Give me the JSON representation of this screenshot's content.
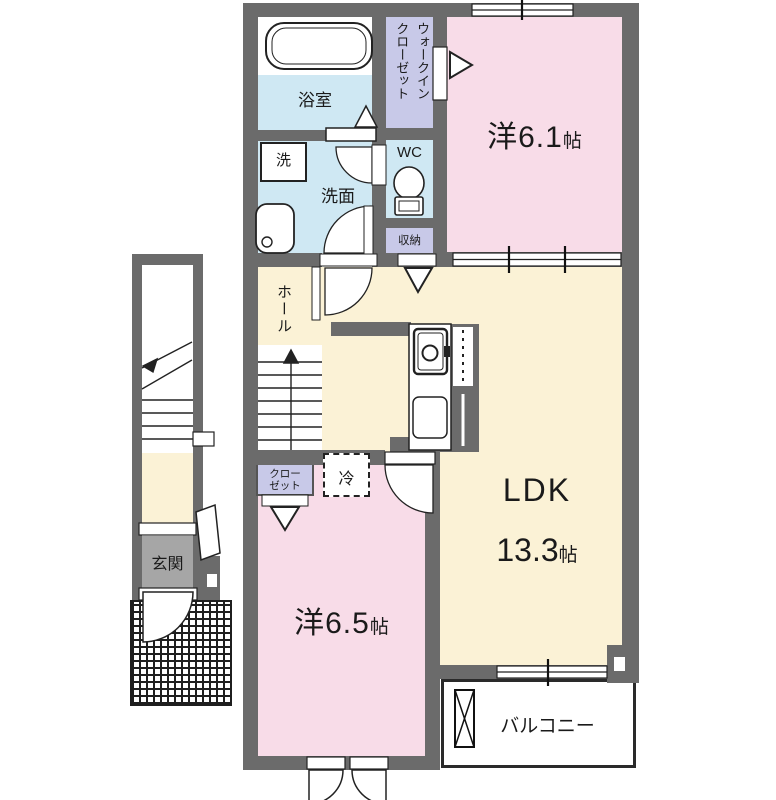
{
  "floorplan": {
    "rooms": {
      "bathroom": {
        "label": "浴室"
      },
      "walk_in_closet": {
        "label_line1": "ウォークイン",
        "label_line2": "クローゼット"
      },
      "bedroom1": {
        "label": "洋6.1",
        "unit": "帖"
      },
      "laundry": {
        "label": "洗"
      },
      "washroom": {
        "label": "洗面"
      },
      "wc": {
        "label": "WC"
      },
      "storage": {
        "label": "収納"
      },
      "hall": {
        "label": "ホール"
      },
      "ldk": {
        "label": "LDK",
        "size": "13.3",
        "unit": "帖"
      },
      "closet": {
        "label_line1": "クロー",
        "label_line2": "ゼット"
      },
      "refrigerator": {
        "label": "冷"
      },
      "bedroom2": {
        "label": "洋6.5",
        "unit": "帖"
      },
      "entrance": {
        "label": "玄関"
      },
      "balcony": {
        "label": "バルコニー"
      }
    },
    "colors": {
      "wall": "#6b6b6b",
      "pink": "#f8dce8",
      "cream": "#fbf2d6",
      "blue": "#cfe8f3",
      "lavender": "#c8c9e8",
      "genkan": "#a6a6a6",
      "text": "#1a1a1a",
      "line": "#222222"
    }
  }
}
